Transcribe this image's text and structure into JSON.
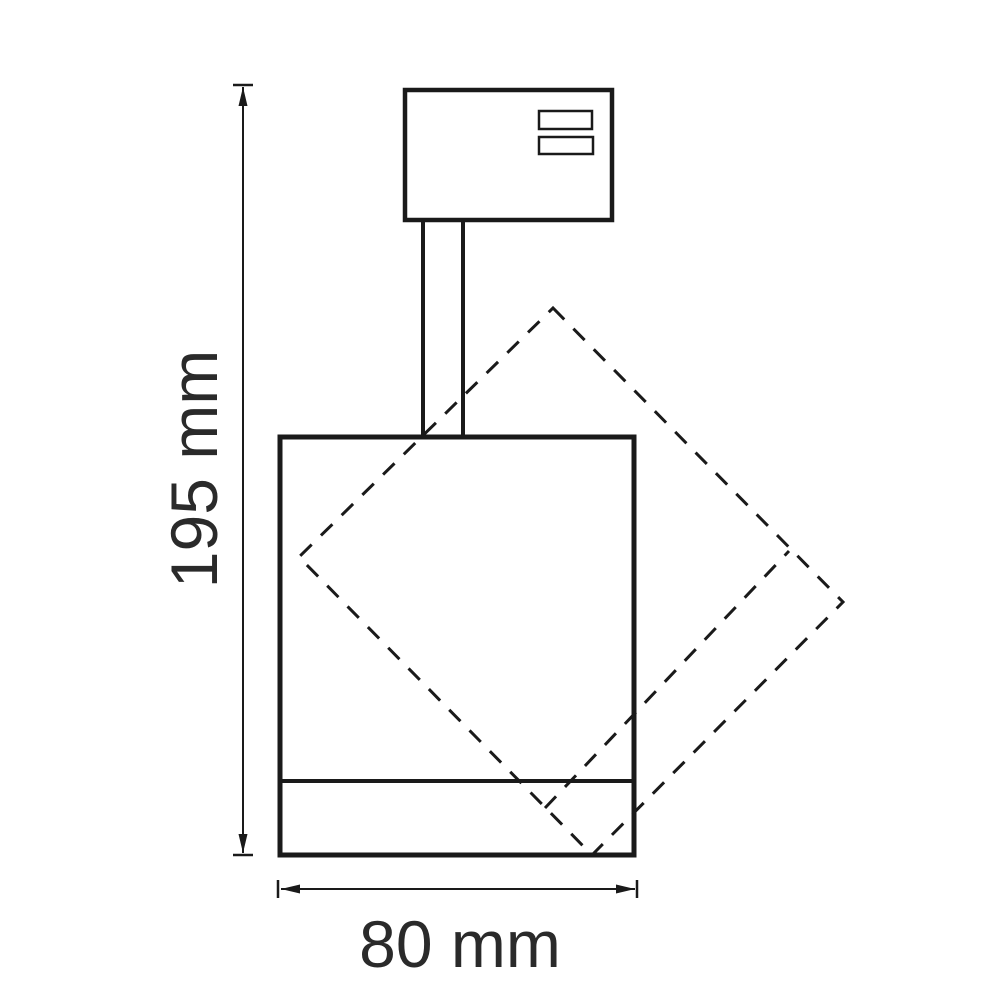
{
  "figure": {
    "background_color": "#ffffff",
    "line_color": "#1a1a1a",
    "text_color": "#2a2a2a",
    "height_dimension": {
      "label": "195 mm",
      "value": 195,
      "unit": "mm"
    },
    "width_dimension": {
      "label": "80 mm",
      "value": 80,
      "unit": "mm"
    }
  }
}
